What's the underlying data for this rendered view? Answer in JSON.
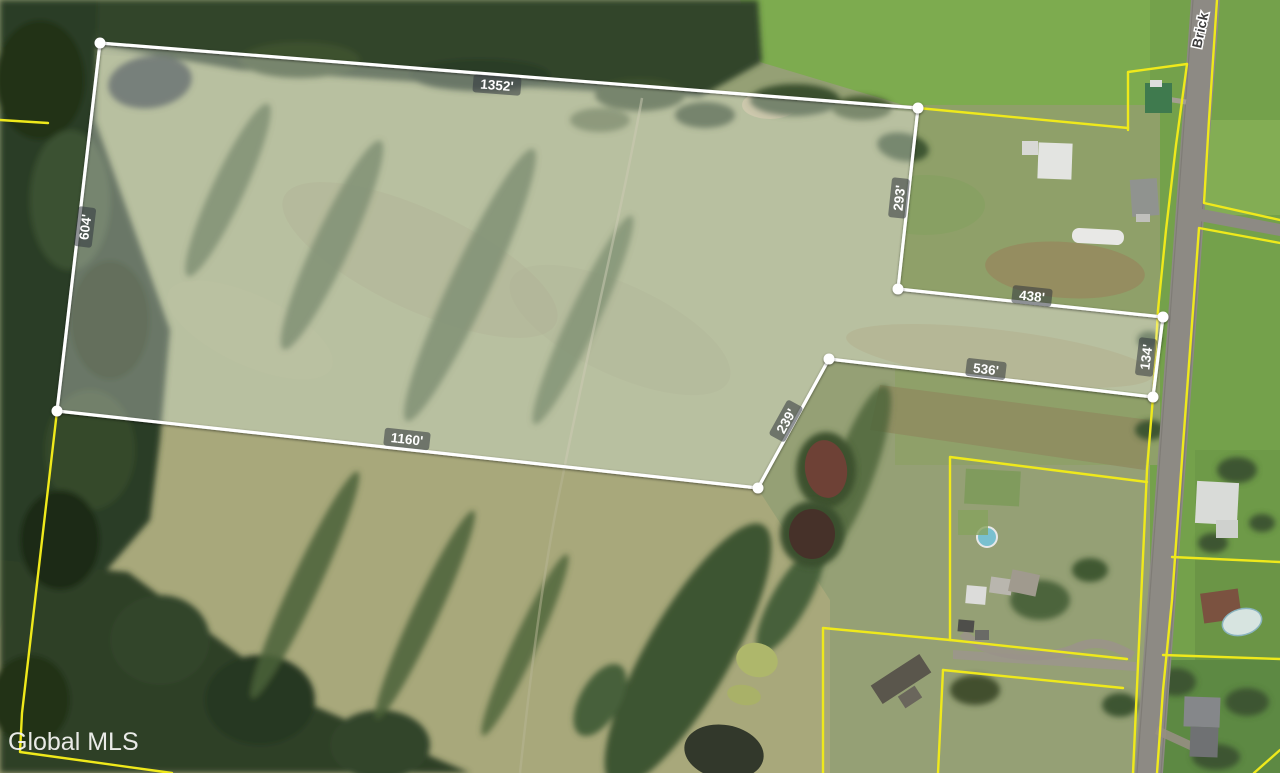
{
  "watermark": "Global MLS",
  "road_label": "Brick",
  "dimensions": {
    "top": "1352'",
    "left": "604'",
    "upper_right": "293'",
    "notch_top": "438'",
    "notch_right": "134'",
    "notch_bottom": "536'",
    "lower_right": "239'",
    "bottom": "1160'"
  },
  "colors": {
    "parcel_outline": "#ffffff",
    "parcel_fill": "rgba(255,255,255,0.30)",
    "boundary_yellow": "#efe91b",
    "dimension_badge": "rgba(50,54,62,0.55)",
    "dimension_text": "#ffffff",
    "road_label_text": "#3d3d3d",
    "watermark_text": "#f4f4f2"
  }
}
